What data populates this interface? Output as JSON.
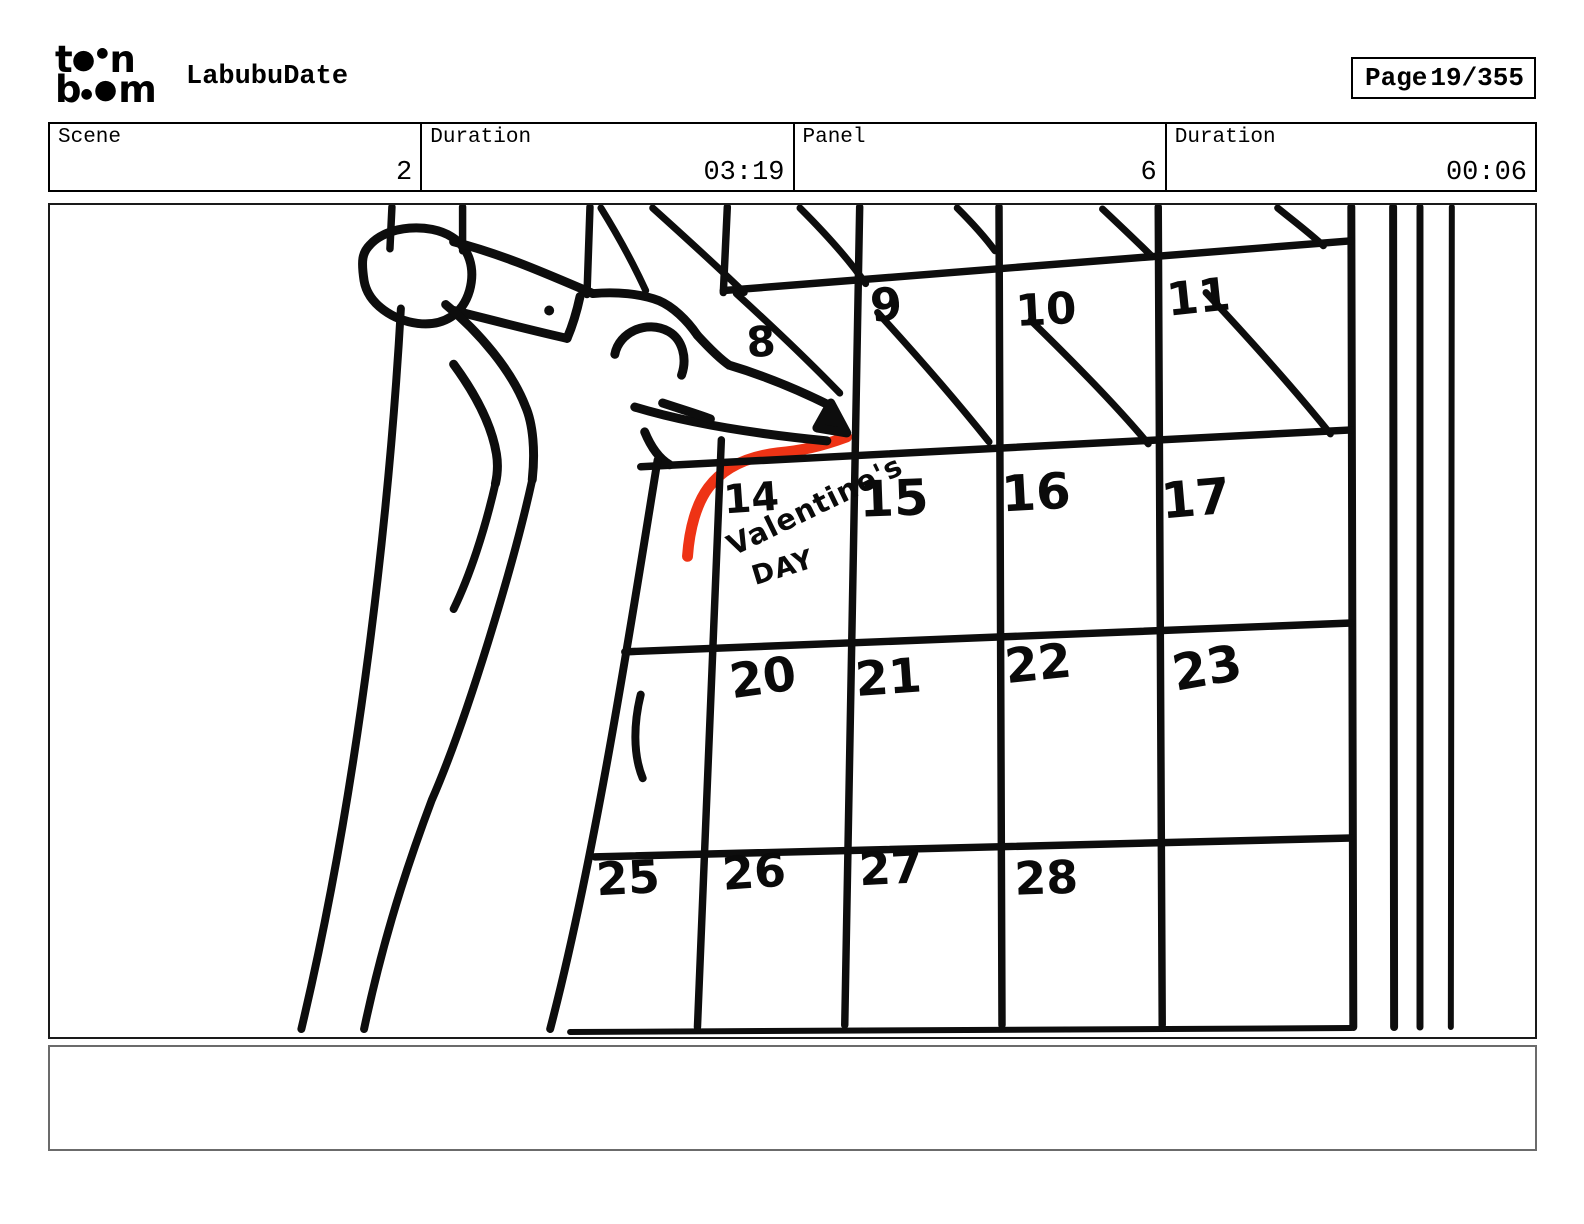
{
  "header": {
    "logo": {
      "brand": "toon boom",
      "line1": [
        "t",
        "●",
        "●",
        "n"
      ],
      "line2": [
        "b",
        "●",
        "●",
        "m"
      ]
    },
    "title": "LabubuDate",
    "page": {
      "label": "Page",
      "value": "19/355"
    }
  },
  "info_bar": [
    {
      "label": "Scene",
      "value": "2"
    },
    {
      "label": "Duration",
      "value": "03:19"
    },
    {
      "label": "Panel",
      "value": "6"
    },
    {
      "label": "Duration",
      "value": "00:06"
    }
  ],
  "sketch": {
    "ink_color": "#0d0d0d",
    "annotation_color": "#ee3315",
    "calendar": {
      "days": [
        "8",
        "9",
        "10",
        "11",
        "14",
        "15",
        "16",
        "17",
        "20",
        "21",
        "22",
        "23",
        "25",
        "26",
        "27",
        "28"
      ],
      "crossed_out_days": [
        "8",
        "9",
        "10",
        "11"
      ],
      "highlighted_day": "14",
      "note_line1": "Valentine's",
      "note_line2": "DAY"
    }
  },
  "caption": {
    "text": ""
  }
}
